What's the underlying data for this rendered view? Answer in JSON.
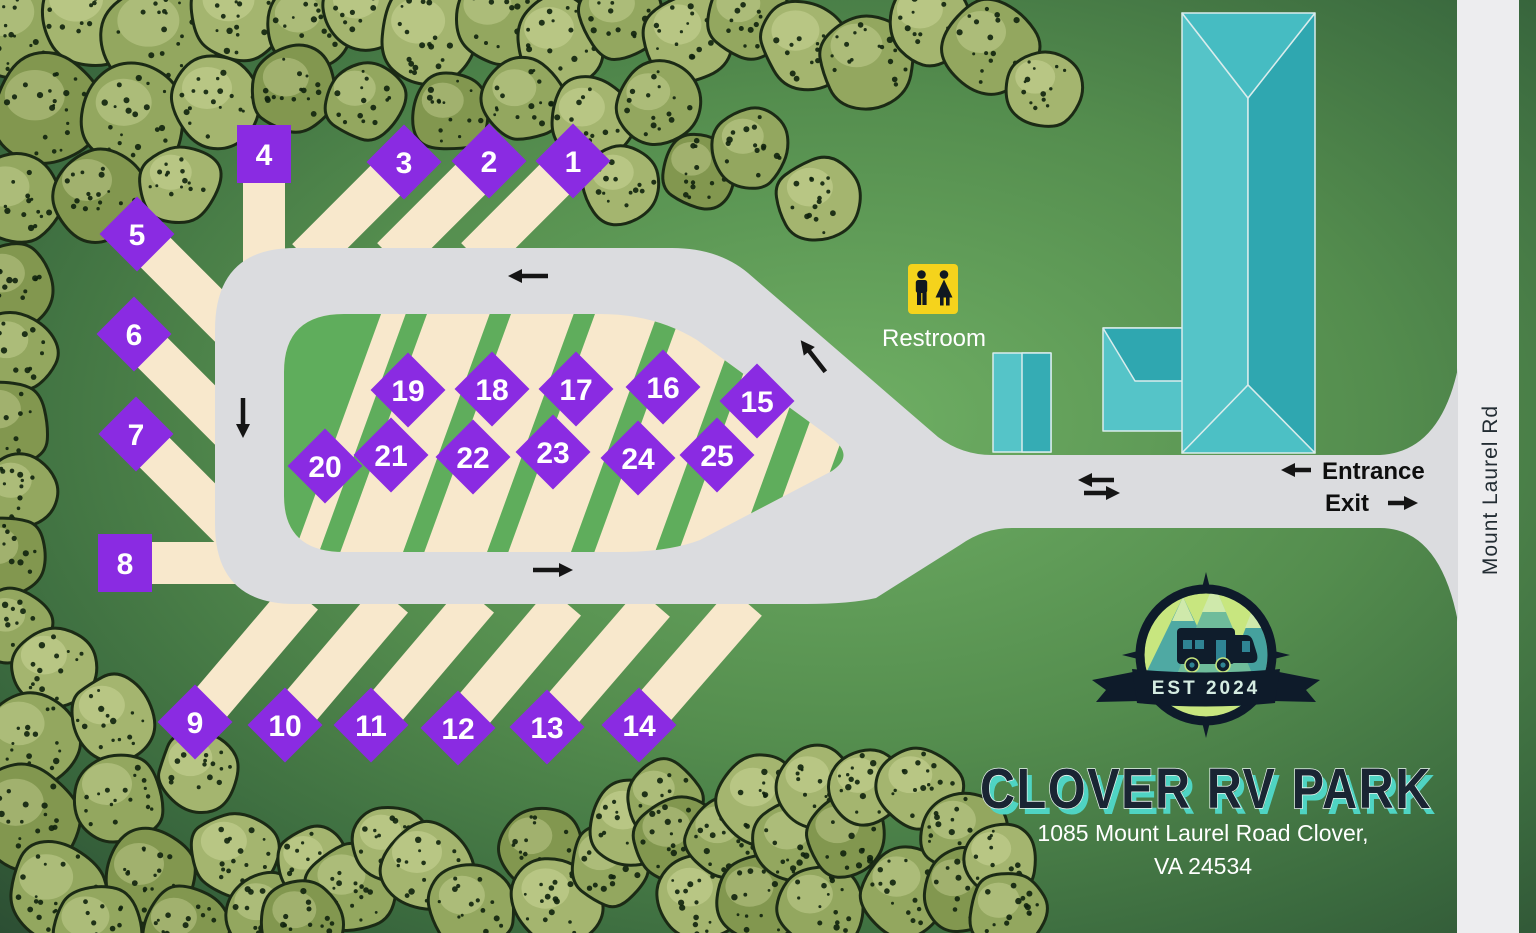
{
  "map_title": "Clover RV Park site map",
  "labels": {
    "restroom": "Restroom",
    "entrance": "Entrance",
    "exit": "Exit",
    "road": "Mount Laurel Rd"
  },
  "logo": {
    "est": "EST 2024",
    "icon": "rv-mountains-compass-badge"
  },
  "title": {
    "name": "CLOVER RV PARK",
    "address1": "1085 Mount Laurel Road Clover,",
    "address2": "VA 24534"
  },
  "sites": {
    "numbers": [
      "1",
      "2",
      "3",
      "4",
      "5",
      "6",
      "7",
      "8",
      "9",
      "10",
      "11",
      "12",
      "13",
      "14",
      "15",
      "16",
      "17",
      "18",
      "19",
      "20",
      "21",
      "22",
      "23",
      "24",
      "25"
    ]
  },
  "colors": {
    "background_center": "#6FAF64",
    "background_mid": "#4D8549",
    "background_edge": "#2C4E33",
    "park_road": "#DBDCDF",
    "public_road": "#EDEDEF",
    "site_strip": "#F8E8CC",
    "island_green": "#5FAD5C",
    "site_marker": "#8A2BE2",
    "marker_text": "#FFFFFF",
    "tree_fills": [
      "#A4B56F",
      "#93A75F",
      "#82974F",
      "#6F8A4A"
    ],
    "tree_outline": "#1B2A15",
    "tree_dots": "#10220D",
    "tree_highlight": "#E4E8B0",
    "building_light": "#55C4C8",
    "building_mid": "#46BCC2",
    "building_dark": "#2FA7B0",
    "building_bottom": "#4CC0C5",
    "building_outline": "#D9ECEC",
    "restroom_yellow": "#F5D31C",
    "figure_black": "#101820",
    "logo_navy": "#0E1B2A",
    "logo_green": "#C8E67F",
    "mountain_teal_1": "#4FA9A3",
    "mountain_teal_2": "#6FBC9B",
    "mountain_teal_3": "#45A19E",
    "mountain_cap": "#CFE9AB",
    "logo_window_teal": "#2F8494",
    "title_navy": "#1A2533",
    "title_teal": "#4FD4C3",
    "arrow_black": "#151515"
  }
}
